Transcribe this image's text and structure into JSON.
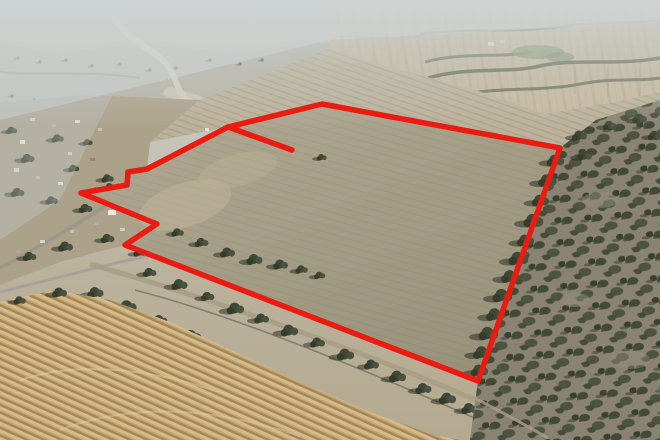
{
  "scene": {
    "type": "aerial-drone-photograph",
    "subject": "Rural township edge and dry farmland with a large paddock outlined in red (property boundary)",
    "features": [
      "hazy pale distant farmland at top",
      "curving gravel road descending from the distance at upper left",
      "township houses and trees along a diagonal road on the left",
      "small rectangular notch excluded from the boundary on the west side",
      "short red spur line from the north-west corner into the paddock",
      "tree-lined rail and road corridor running to the lower right",
      "golden harvested stubble field with diagonal windrow stripes in the foreground",
      "open grey-khaki grazing paddock inside the red boundary",
      "dense scattered woodland down the right side"
    ]
  },
  "colors": {
    "boundary_red": "#ea1c12",
    "haze": "#cdd2d1",
    "far_field_tan": "#c8baa0",
    "outer_paddock": "#bcb199",
    "paddock": "#a59e87",
    "stubble_light": "#d6bb88",
    "stubble_dark": "#a2875b",
    "tree_dark": "#3f4836",
    "woodland_ground": "#8a8371",
    "road_grey": "#9b968b"
  },
  "boundary": {
    "stroke_width": 5.5,
    "outline_points": [
      [
        228,
        127
      ],
      [
        147,
        169
      ],
      [
        128,
        172
      ],
      [
        127,
        185
      ],
      [
        81,
        193
      ],
      [
        157,
        224
      ],
      [
        125,
        245
      ],
      [
        478,
        381
      ],
      [
        560,
        148
      ],
      [
        322,
        104
      ]
    ],
    "spur_points": [
      [
        228,
        127
      ],
      [
        292,
        150
      ]
    ]
  }
}
